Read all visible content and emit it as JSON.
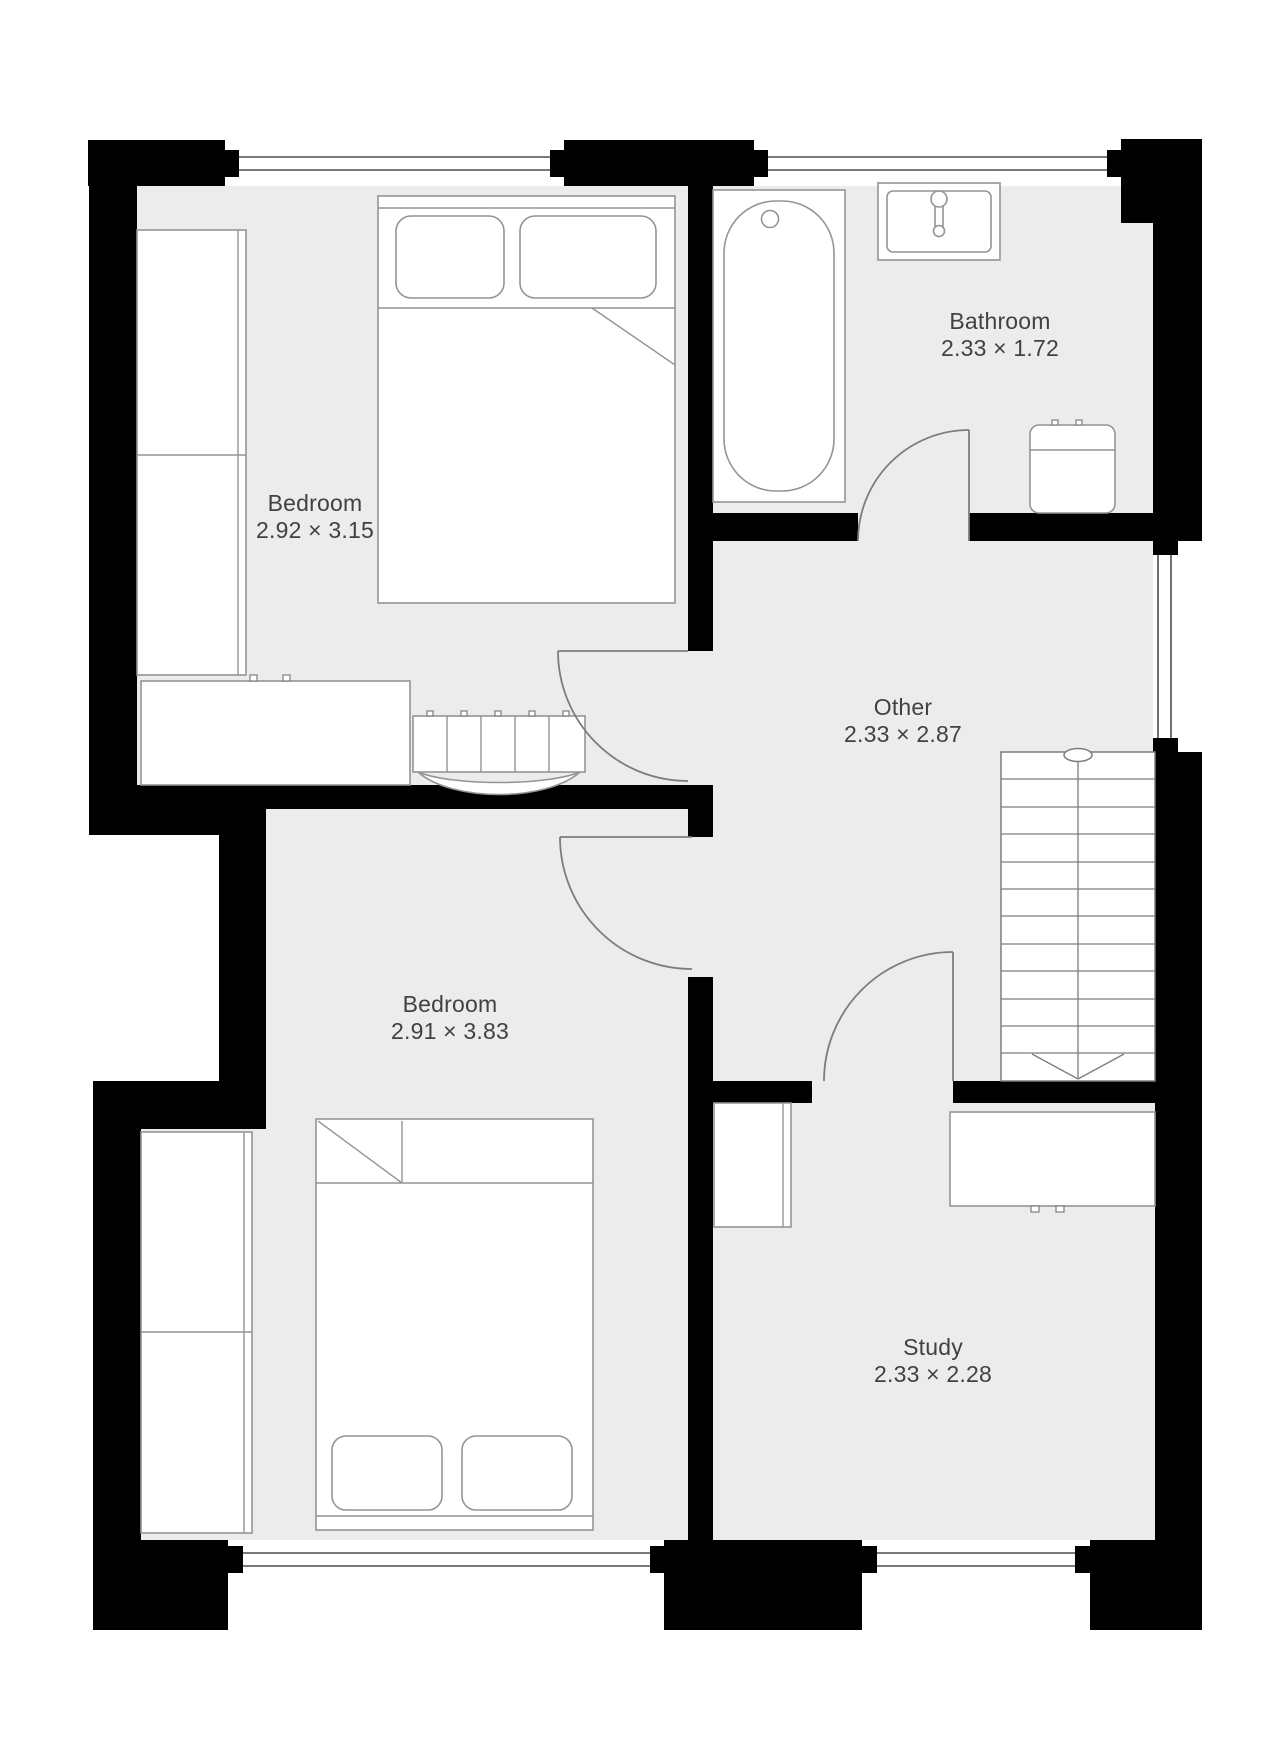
{
  "document": {
    "type": "floor-plan",
    "floor": "upper"
  },
  "colors": {
    "background": "#ffffff",
    "wall": "#000000",
    "floor": "#ececec",
    "furniture_line": "#949494",
    "door_line": "#7d7d7d",
    "label_text": "#3e4245"
  },
  "rooms": [
    {
      "id": "bedroom-1",
      "name": "Bedroom",
      "dims": "2.92 × 3.15"
    },
    {
      "id": "bathroom",
      "name": "Bathroom",
      "dims": "2.33 × 1.72"
    },
    {
      "id": "other",
      "name": "Other",
      "dims": "2.33 × 2.87"
    },
    {
      "id": "bedroom-2",
      "name": "Bedroom",
      "dims": "2.91 × 3.83"
    },
    {
      "id": "study",
      "name": "Study",
      "dims": "2.33 × 2.28"
    }
  ],
  "fixtures": {
    "bedroom_1": [
      "wardrobe-icon",
      "dresser-icon",
      "double-bed-icon",
      "dressing-table-icon"
    ],
    "bathroom": [
      "bathtub-icon",
      "sink-icon",
      "toilet-icon"
    ],
    "other": [
      "staircase-down-icon"
    ],
    "bedroom_2": [
      "wardrobe-icon",
      "double-bed-icon"
    ],
    "study": [
      "cupboard-icon",
      "desk-icon"
    ]
  },
  "doors": [
    "bathroom-door",
    "bedroom-1-door",
    "bedroom-2-door",
    "study-door"
  ],
  "windows": [
    "bedroom-1-window-top",
    "bathroom-window-top",
    "landing-window-right",
    "bedroom-2-window-bottom",
    "study-window-bottom"
  ]
}
